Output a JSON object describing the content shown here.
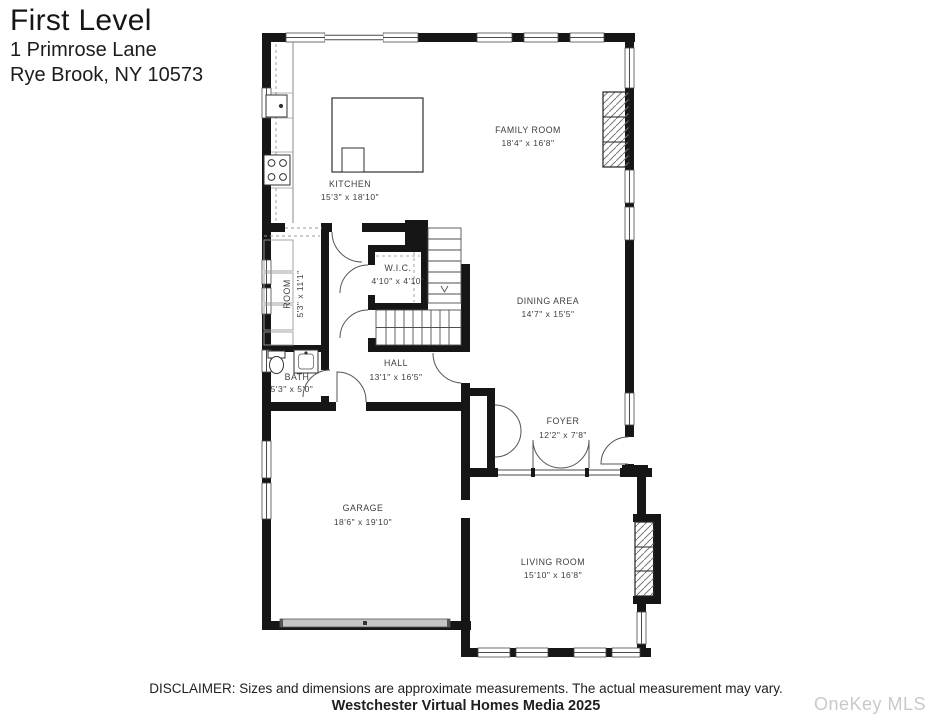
{
  "header": {
    "title": "First Level",
    "address_line1": "1 Primrose Lane",
    "address_line2": "Rye Brook, NY 10573"
  },
  "rooms": [
    {
      "id": "family-room",
      "name": "FAMILY ROOM",
      "dims": "18'4\" x 16'8\""
    },
    {
      "id": "kitchen",
      "name": "KITCHEN",
      "dims": "15'3\" x 18'10\""
    },
    {
      "id": "wic",
      "name": "W.I.C.",
      "dims": "4'10\" x 4'10\""
    },
    {
      "id": "room",
      "name": "ROOM",
      "dims": "5'3\" x 11'1\""
    },
    {
      "id": "dining-area",
      "name": "DINING AREA",
      "dims": "14'7\" x 15'5\""
    },
    {
      "id": "bath",
      "name": "BATH",
      "dims": "5'3\" x 5'0\""
    },
    {
      "id": "hall",
      "name": "HALL",
      "dims": "13'1\" x 16'5\""
    },
    {
      "id": "foyer",
      "name": "FOYER",
      "dims": "12'2\" x 7'8\""
    },
    {
      "id": "garage",
      "name": "GARAGE",
      "dims": "18'6\" x 19'10\""
    },
    {
      "id": "living-room",
      "name": "LIVING ROOM",
      "dims": "15'10\" x 16'8\""
    }
  ],
  "footer": {
    "disclaimer": "DISCLAIMER: Sizes and dimensions are approximate measurements. The actual measurement may vary.",
    "credit": "Westchester Virtual Homes Media 2025",
    "watermark": "OneKey MLS"
  },
  "colors": {
    "wall": "#161616",
    "watermark": "#c9c9c9"
  }
}
